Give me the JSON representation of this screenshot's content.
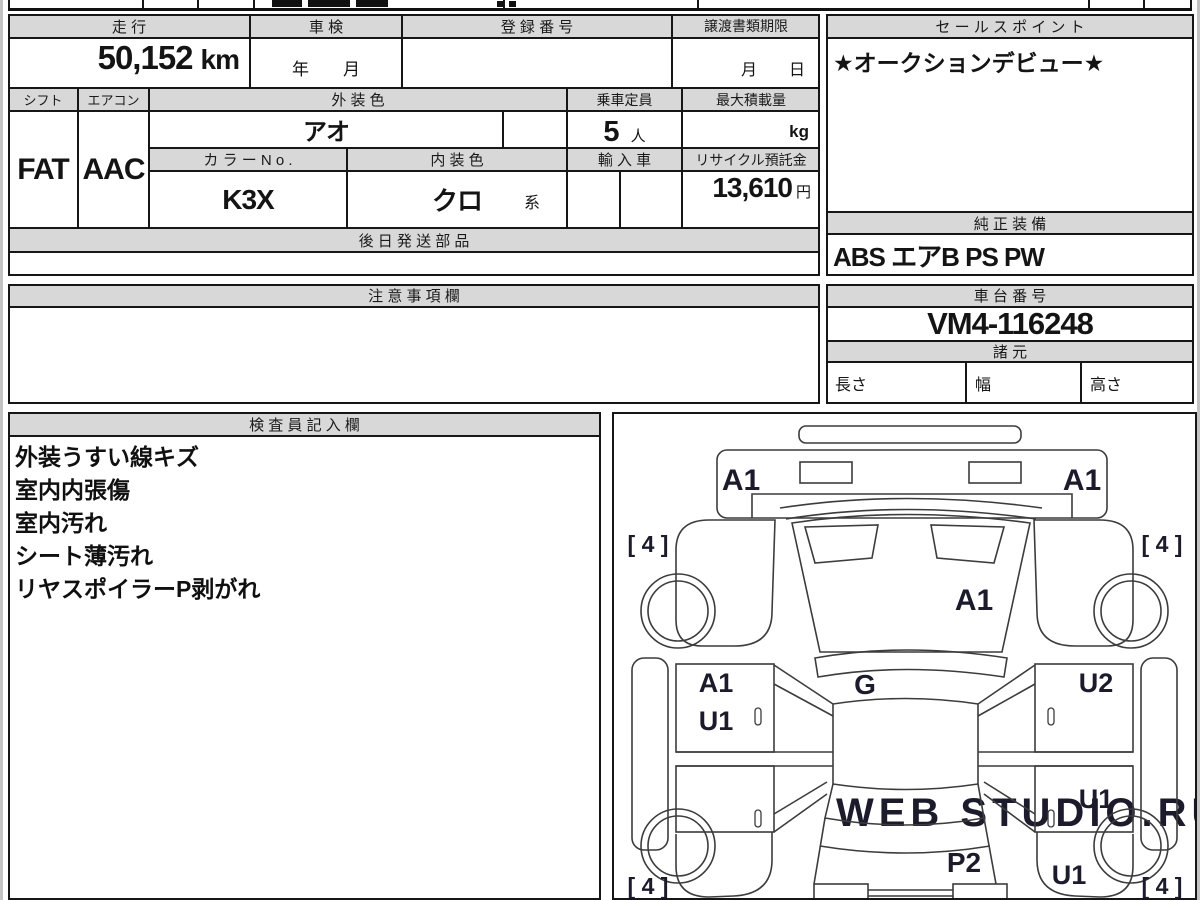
{
  "sheet": {
    "colors": {
      "header_bg": "#d8d8d8",
      "border": "#161616"
    },
    "main": {
      "mileage": {
        "label": "走 行",
        "value": "50,152",
        "unit": "km"
      },
      "inspection": {
        "label": "車 検",
        "value": "年　　月"
      },
      "registration": {
        "label": "登 録 番 号",
        "value": ""
      },
      "transfer_deadline": {
        "label": "譲渡書類期限",
        "value": "月　　日"
      },
      "sales_point": {
        "label": "セ ー ル ス ポ イ ン ト",
        "value": "★オークションデビュー★"
      },
      "shift": {
        "label": "シフト",
        "value": "FAT"
      },
      "aircon": {
        "label": "エアコン",
        "value": "AAC"
      },
      "exterior_color": {
        "label": "外 装 色",
        "value": "アオ"
      },
      "capacity": {
        "label": "乗車定員",
        "value": "5",
        "unit": "人"
      },
      "max_load": {
        "label": "最大積載量",
        "value": "",
        "unit": "kg"
      },
      "color_no": {
        "label": "カ ラ ー N o .",
        "value": "K3X"
      },
      "interior_color": {
        "label": "内 装 色",
        "value": "クロ",
        "suffix": "系"
      },
      "import_car": {
        "label": "輸 入 車",
        "value": ""
      },
      "recycle_deposit": {
        "label": "リサイクル預託金",
        "value": "13,610",
        "unit": "円"
      },
      "later_parts": {
        "label": "後 日 発 送 部 品",
        "value": ""
      },
      "genuine_equipment": {
        "label": "純 正 装 備",
        "value": "ABS エアB PS PW"
      },
      "caution": {
        "label": "注 意 事 項 欄",
        "value": ""
      },
      "chassis_no": {
        "label": "車 台 番 号",
        "value": "VM4-116248"
      },
      "specs": {
        "label": "諸 元",
        "length_label": "長さ",
        "width_label": "幅",
        "height_label": "高さ"
      },
      "inspector": {
        "label": "検 査 員 記 入 欄",
        "lines": [
          "外装うすい線キズ",
          "室内内張傷",
          "室内汚れ",
          "シート薄汚れ",
          "リヤスポイラーP剥がれ"
        ]
      }
    },
    "diagram": {
      "labels": {
        "rear_left": "A1",
        "rear_right": "A1",
        "tire_rear_left": "[ 4 ]",
        "tire_rear_right": "[ 4 ]",
        "roof": "A1",
        "center": "G",
        "left_door_upper": "A1",
        "left_door_lower": "U1",
        "right_door_upper": "U2",
        "right_door_lower": "U1",
        "hood": "P2",
        "front_right": "U1",
        "tire_front_left": "[ 4 ]",
        "tire_front_right": "[ 4 ]"
      },
      "watermark": "WEB STUDIO.RU"
    }
  }
}
